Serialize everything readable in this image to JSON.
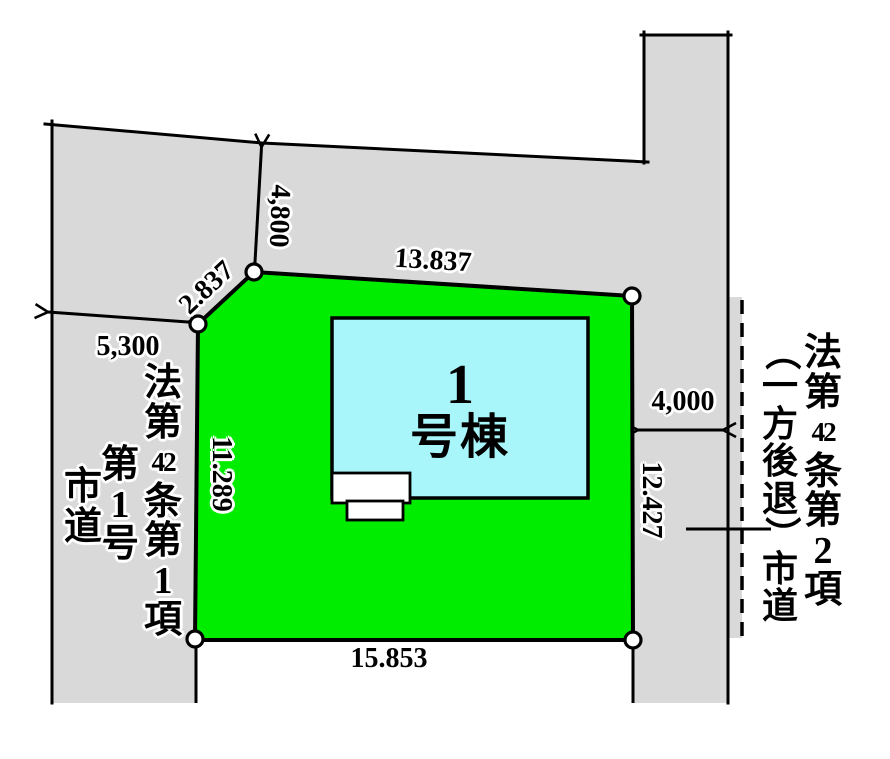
{
  "colors": {
    "road_gray": "#d9d9d9",
    "plot_green": "#00ed00",
    "building_cyan": "#a8f6f9",
    "line_black": "#000000",
    "vertex_marker_white": "#ffffff"
  },
  "plot": {
    "dimensions": {
      "top_edge": "13.837",
      "bottom_edge": "15.853",
      "left_edge": "11.289",
      "right_edge": "12.427",
      "diagonal_corner_edge": "2.837"
    },
    "building": {
      "label_line1": "1",
      "label_line2": "号棟",
      "full_text": "1号棟"
    }
  },
  "road": {
    "dimensions": {
      "upper_left_frontage": "5,300",
      "upper_band_width": "4,800",
      "right_road_width": "4,000"
    },
    "left_label": {
      "full_text": "法第42条第1項第1号市道",
      "col1_cells": [
        "法",
        "第",
        "42",
        "条",
        "第",
        "1",
        "項"
      ],
      "col2_cells": [
        "第",
        "1",
        "号"
      ],
      "col3_cells": [
        "市",
        "道"
      ]
    },
    "right_label": {
      "full_text": "法第42条第2項（一方後退）市道",
      "col1_cells": [
        "法",
        "第",
        "42",
        "条",
        "第",
        "2",
        "項"
      ],
      "col2_cells": [
        "（",
        "一",
        "方",
        "後",
        "退",
        "）",
        "市",
        "道"
      ]
    }
  }
}
